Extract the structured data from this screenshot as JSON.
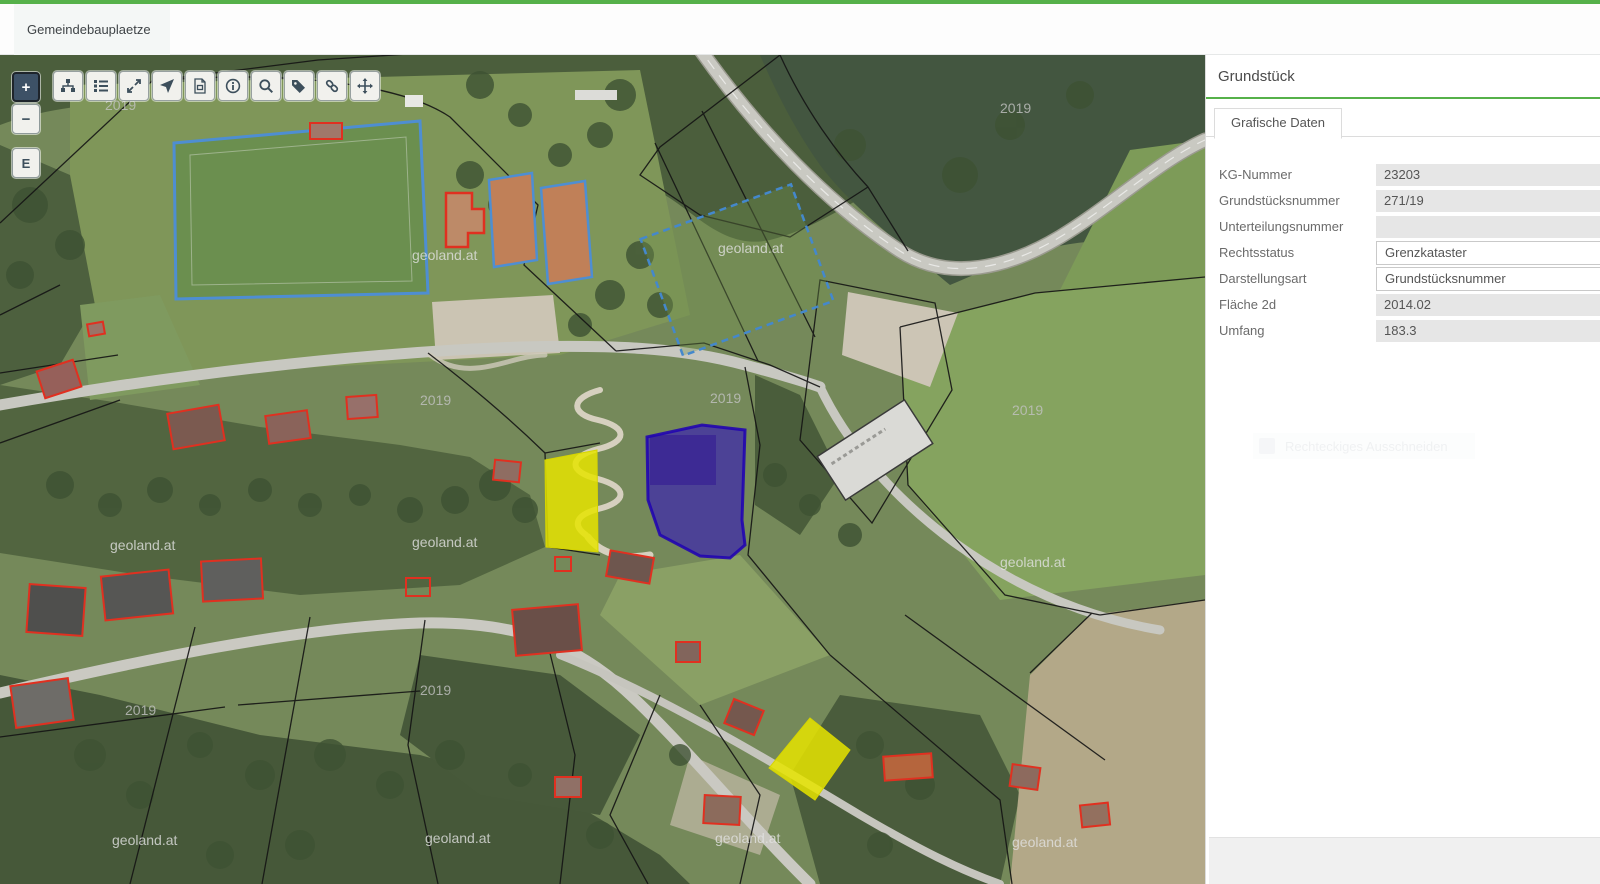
{
  "topbar": {
    "tab_label": "Gemeindebauplaetze"
  },
  "colors": {
    "accent_green": "#56b14a",
    "selection_blue": "#2a08c8",
    "highlight_yellow": "#e6e400",
    "building_red": "#e03020",
    "sport_field_blue": "#4e8ed2"
  },
  "map": {
    "controls": {
      "zoom_in": "+",
      "zoom_out": "−",
      "edit_mode": "E"
    },
    "toolbar_icons": [
      "sitemap",
      "list",
      "resize",
      "location-arrow",
      "pdf-export",
      "info",
      "search",
      "tag",
      "link",
      "move"
    ],
    "watermark_year": "2019",
    "watermark_source": "geoland.at"
  },
  "panel": {
    "title": "Grundstück",
    "tab_label": "Grafische Daten",
    "fields": [
      {
        "key": "kg-nummer",
        "label": "KG-Nummer",
        "value": "23203",
        "editable": false
      },
      {
        "key": "grundstuecksnummer",
        "label": "Grundstücksnummer",
        "value": "271/19",
        "editable": false
      },
      {
        "key": "unterteilungsnummer",
        "label": "Unterteilungsnummer",
        "value": "",
        "editable": false
      },
      {
        "key": "rechtsstatus",
        "label": "Rechtsstatus",
        "value": "Grenzkataster",
        "editable": true
      },
      {
        "key": "darstellungsart",
        "label": "Darstellungsart",
        "value": "Grundstücksnummer",
        "editable": true
      },
      {
        "key": "flaeche-2d",
        "label": "Fläche 2d",
        "value": "2014.02",
        "editable": false
      },
      {
        "key": "umfang",
        "label": "Umfang",
        "value": "183.3",
        "editable": false
      }
    ],
    "ghost_label": "Rechteckiges Ausschneiden"
  }
}
